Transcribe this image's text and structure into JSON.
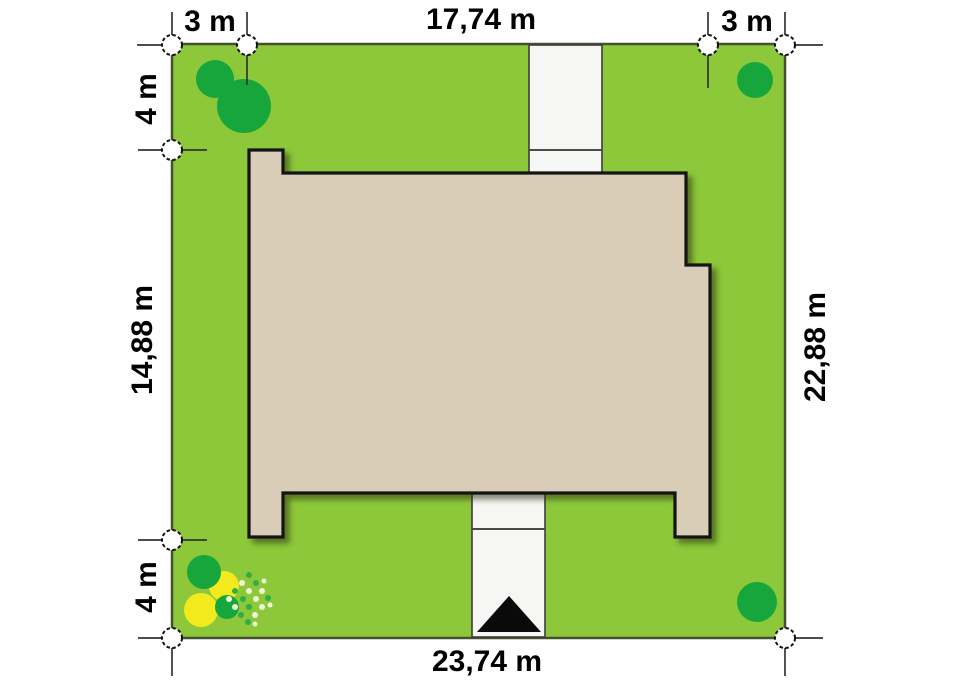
{
  "plan": {
    "name": "house-site-plan",
    "dimensions": {
      "top": {
        "left_offset": "3 m",
        "house_width": "17,74 m",
        "right_offset": "3 m"
      },
      "left": {
        "top_offset": "4 m",
        "house_depth": "14,88 m",
        "bottom_offset": "4 m"
      },
      "right": {
        "plot_depth": "22,88 m"
      },
      "bottom": {
        "plot_width": "23,74 m"
      }
    },
    "colors": {
      "background": "#ffffff",
      "plot_green": "#8cc83a",
      "plot_border": "#474f33",
      "house_fill": "#d9cdb8",
      "house_outline": "#141414",
      "driveway_fill": "#f6f6f5",
      "tree_green": "#16a63c",
      "bush_yellow": "#f2ea1c",
      "stipple_light": "#eef7d8",
      "stipple_green": "#2fae47",
      "marker_fill": "#ffffff",
      "marker_stroke": "#111111",
      "entrance_arrow": "#0a0a0a"
    }
  }
}
